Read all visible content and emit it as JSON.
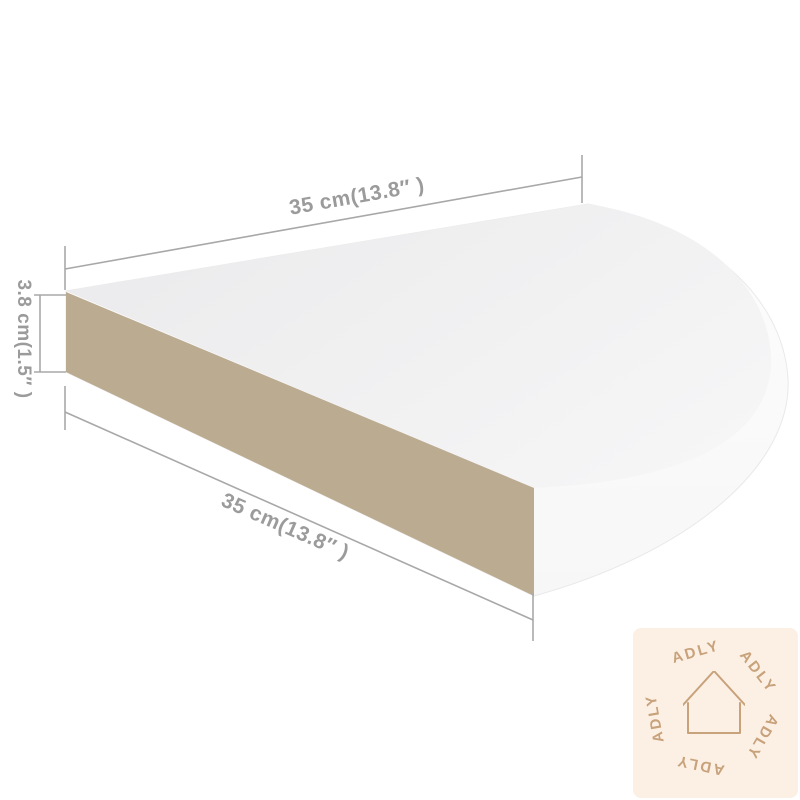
{
  "diagram": {
    "dimensions": {
      "top_width": "35 cm(13.8″ )",
      "bottom_width": "35 cm(13.8″ )",
      "height": "3.8 cm(1.5″ )"
    },
    "colors": {
      "shelf_top_face": "#f0f0f1",
      "shelf_front_face": "#bbab90",
      "shelf_side_face": "#fbfbfc",
      "dimension_line": "#a8a8a8",
      "dimension_text": "#9b9b9b",
      "background": "#ffffff"
    }
  },
  "watermark": {
    "brand": "ADLY",
    "icon": "house-outline-icon",
    "words": [
      "ADLY",
      "ADLY",
      "ADLY",
      "ADLY",
      "ADLY"
    ],
    "colors": {
      "background": "#fcf0e5",
      "foreground": "#c7a27b"
    }
  }
}
